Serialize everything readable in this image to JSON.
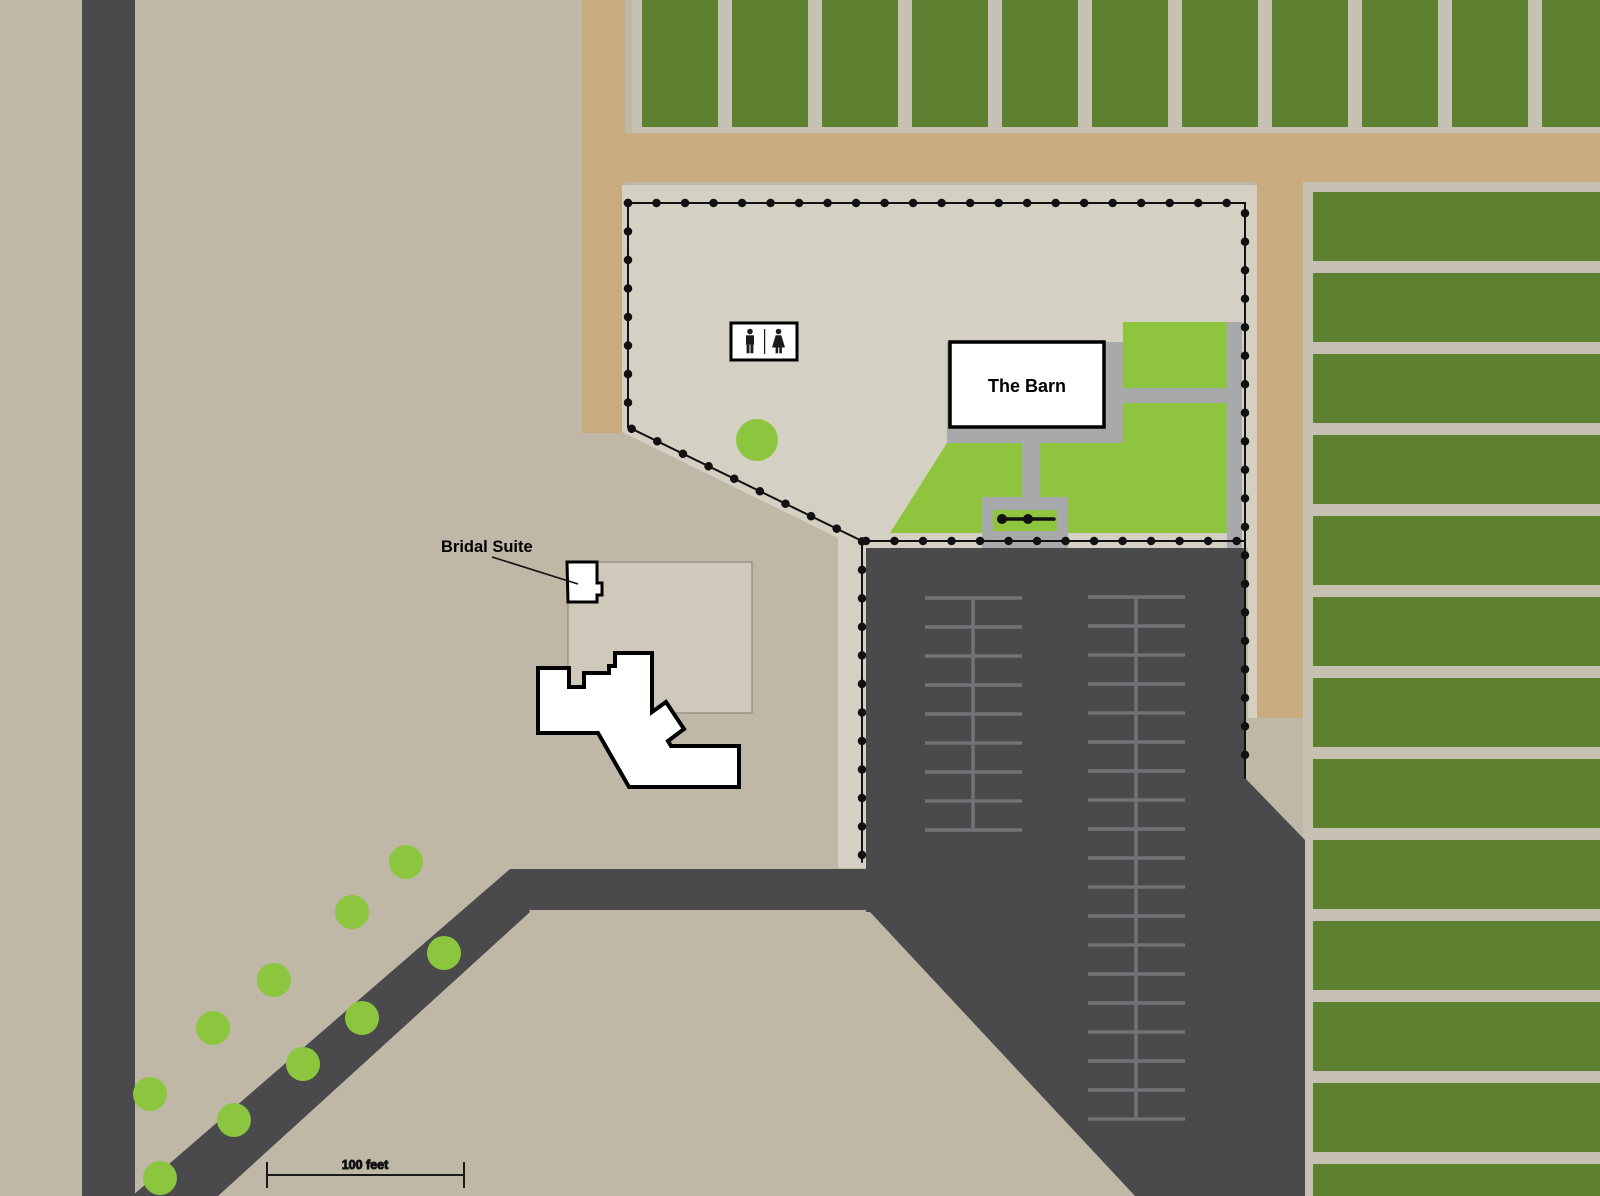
{
  "map": {
    "labels": {
      "barn": "The Barn",
      "bridal_suite": "Bridal Suite",
      "scale": "100 feet"
    },
    "colors": {
      "background_tan": "#bfb8a7",
      "farm_road_khaki": "#c8ab7e",
      "crop_green": "#5d8130",
      "field_gap": "#c7c1b3",
      "event_area": "#d5d0c4",
      "lawn_green": "#8fc43e",
      "tree_green": "#8cc63f",
      "concrete": "#a8a9ab",
      "asphalt": "#4a4a4c",
      "parking_line": "#717376",
      "boundary": "#111111",
      "building_fill": "#ffffff",
      "building_outline": "#000000",
      "courtyard": "#cfc9bc",
      "courtyard_border": "#90897b",
      "sign_background": "#ffffff",
      "sign_border": "#000000",
      "icon_black": "#1a1a1a",
      "scale_bar": "#1a1a1a"
    },
    "north_fields": {
      "x_start": 642,
      "pitch": 90,
      "strip_width": 76,
      "y": 0,
      "height": 127,
      "count": 11
    },
    "east_fields": {
      "x": 1313,
      "strip_width": 287,
      "y_start": 192,
      "pitch": 81,
      "strip_height": 69,
      "count": 13
    },
    "parking_bays": [
      {
        "name": "west-bay",
        "spine_x": 973,
        "x1": 925,
        "x2": 1022,
        "y_start": 598,
        "step": 29,
        "count": 9
      },
      {
        "name": "east-bay",
        "spine_x": 1136,
        "x1": 1088,
        "x2": 1185,
        "y_start": 597,
        "step": 29,
        "count": 19
      }
    ],
    "trees": [
      [
        406,
        862
      ],
      [
        352,
        912
      ],
      [
        444,
        953
      ],
      [
        274,
        980
      ],
      [
        362,
        1018
      ],
      [
        213,
        1028
      ],
      [
        303,
        1064
      ],
      [
        150,
        1094
      ],
      [
        234,
        1120
      ],
      [
        160,
        1178
      ]
    ],
    "tree_radius": 17,
    "event_tree": [
      757,
      440
    ],
    "event_tree_radius": 21
  }
}
